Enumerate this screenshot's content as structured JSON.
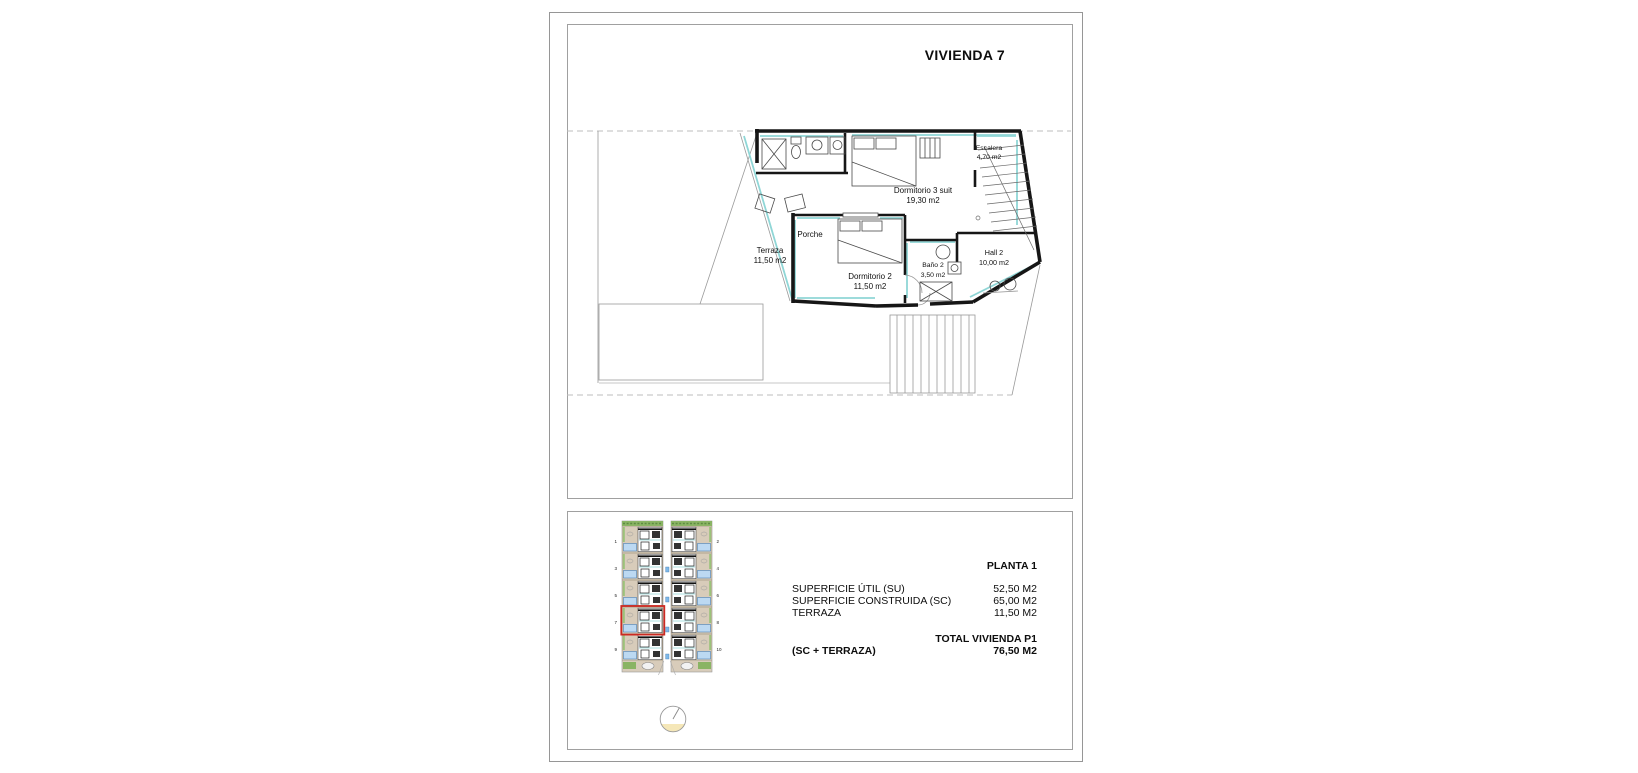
{
  "title": "VIVIENDA 7",
  "plan": {
    "rooms": [
      {
        "name": "Escalera",
        "area": "4,70 m2"
      },
      {
        "name": "Dormitorio 3 suit",
        "area": "19,30 m2"
      },
      {
        "name": "Porche",
        "area": ""
      },
      {
        "name": "Terraza",
        "area": "11,50 m2"
      },
      {
        "name": "Dormitorio 2",
        "area": "11,50 m2"
      },
      {
        "name": "Baño 2",
        "area": "3,50 m2"
      },
      {
        "name": "Hall 2",
        "area": "10,00 m2"
      }
    ]
  },
  "site_plan": {
    "left_unit_numbers": [
      "1",
      "3",
      "5",
      "7",
      "9"
    ],
    "right_unit_numbers": [
      "2",
      "4",
      "6",
      "8",
      "10"
    ],
    "highlighted_unit": "7"
  },
  "summary": {
    "heading": "PLANTA 1",
    "rows": [
      {
        "label": "SUPERFICIE ÚTIL (SU)",
        "value": "52,50 M2"
      },
      {
        "label": "SUPERFICIE CONSTRUIDA (SC)",
        "value": "65,00 M2"
      },
      {
        "label": "TERRAZA",
        "value": "11,50 M2"
      }
    ],
    "total_label": "TOTAL VIVIENDA P1",
    "total_sublabel": "(SC + TERRAZA)",
    "total_value": "76,50 M2"
  },
  "colors": {
    "accent_cyan": "#8fd6d6",
    "site_tan": "#d8ccba",
    "hedge_green": "#8ab464",
    "pool_blue": "#bcd9f2",
    "highlight_red": "#cc2a22",
    "compass_yellow": "#f5e7b8"
  }
}
